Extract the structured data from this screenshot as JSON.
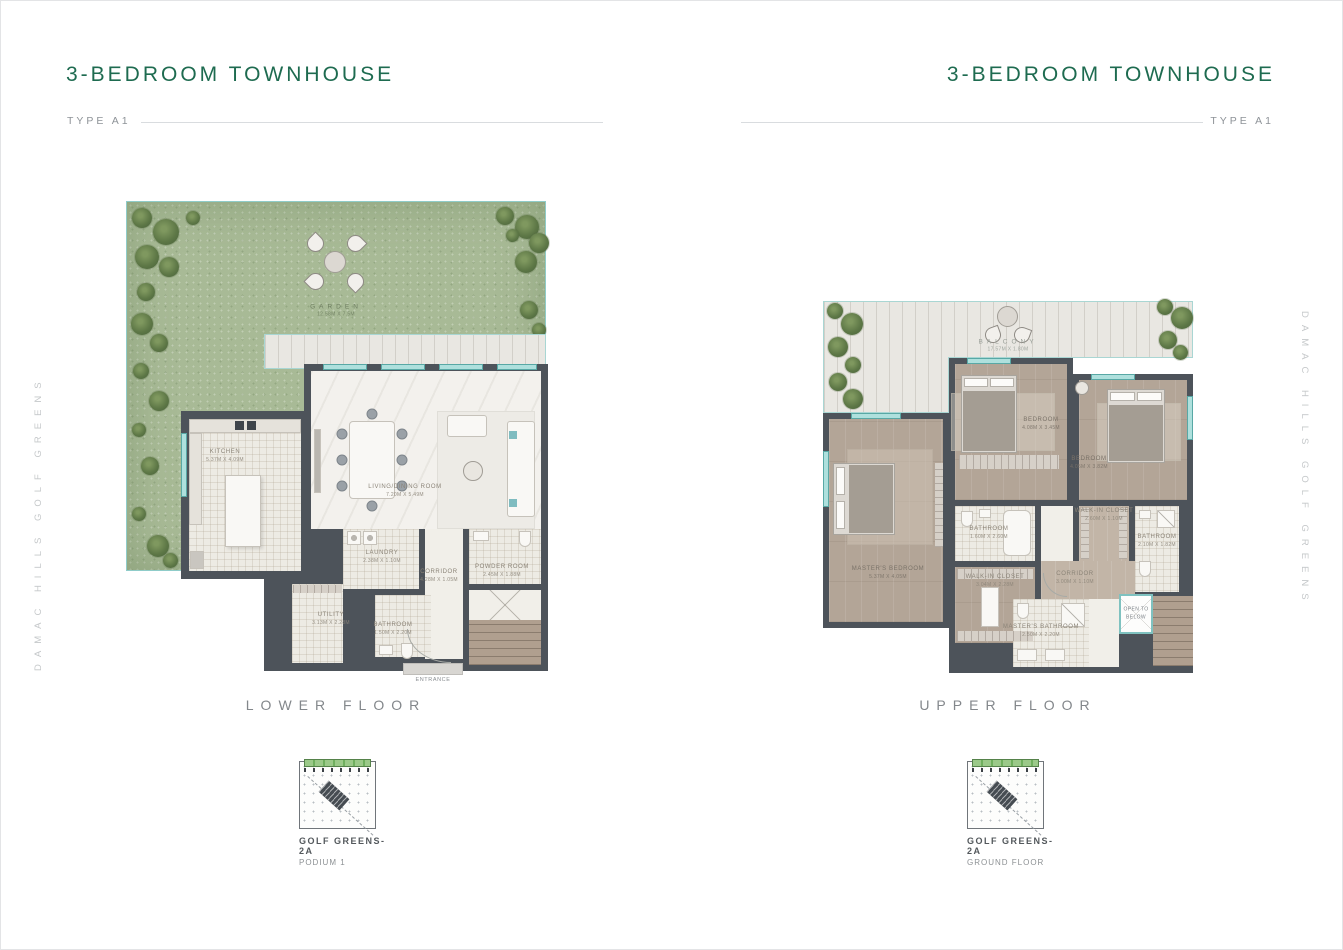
{
  "header_left": {
    "title": "3-BEDROOM TOWNHOUSE",
    "type": "TYPE A1"
  },
  "header_right": {
    "title": "3-BEDROOM TOWNHOUSE",
    "type": "TYPE A1"
  },
  "side_left": "DAMAC HILLS GOLF GREENS",
  "side_right": "DAMAC HILLS GOLF GREENS",
  "lower": {
    "caption": "LOWER FLOOR",
    "keyplan": {
      "title": "GOLF GREENS-2A",
      "subtitle": "PODIUM 1"
    },
    "rooms": {
      "garden": {
        "name": "GARDEN",
        "dims": "12.58M X 7.5M"
      },
      "kitchen": {
        "name": "KITCHEN",
        "dims": "5.37M X 4.09M"
      },
      "living": {
        "name": "LIVING/DINING ROOM",
        "dims": "7.20M X 5.49M"
      },
      "laundry": {
        "name": "LAUNDRY",
        "dims": "2.38M X 1.10M"
      },
      "corridor": {
        "name": "CORRIDOR",
        "dims": "4.28M X 1.05M"
      },
      "powder": {
        "name": "POWDER ROOM",
        "dims": "2.45M X 1.88M"
      },
      "utility": {
        "name": "UTILITY",
        "dims": "3.13M X 2.28M"
      },
      "bathroom": {
        "name": "BATHROOM",
        "dims": "1.50M X 2.20M"
      },
      "entrance": {
        "name": "ENTRANCE"
      }
    }
  },
  "upper": {
    "caption": "UPPER FLOOR",
    "keyplan": {
      "title": "GOLF GREENS-2A",
      "subtitle": "GROUND FLOOR"
    },
    "rooms": {
      "balcony": {
        "name": "BALCONY",
        "dims": "17.57M X 1.80M"
      },
      "master_bedroom": {
        "name": "MASTER'S BEDROOM",
        "dims": "5.37M X 4.05M"
      },
      "bedroom2": {
        "name": "BEDROOM",
        "dims": "4.08M X 3.45M"
      },
      "bedroom3": {
        "name": "BEDROOM",
        "dims": "4.05M X 3.82M"
      },
      "bathroom2": {
        "name": "BATHROOM",
        "dims": "1.60M X 2.60M"
      },
      "walkin_right": {
        "name": "WALK-IN CLOSET",
        "dims": "2.60M X 1.10M"
      },
      "bathroom3": {
        "name": "BATHROOM",
        "dims": "2.10M X 1.82M"
      },
      "walkin_left": {
        "name": "WALK-IN CLOSET",
        "dims": "3.04M X 2.28M"
      },
      "corridor": {
        "name": "CORRIDOR",
        "dims": "3.00M X 1.10M"
      },
      "master_bath": {
        "name": "MASTER'S BATHROOM",
        "dims": "2.50M X 2.20M"
      },
      "open_below": {
        "name": "OPEN TO BELOW"
      }
    }
  },
  "colors": {
    "accent_green": "#1e6b50",
    "teal": "#8ccac9",
    "wall": "#4d535a",
    "garden": "#a8ba96"
  }
}
